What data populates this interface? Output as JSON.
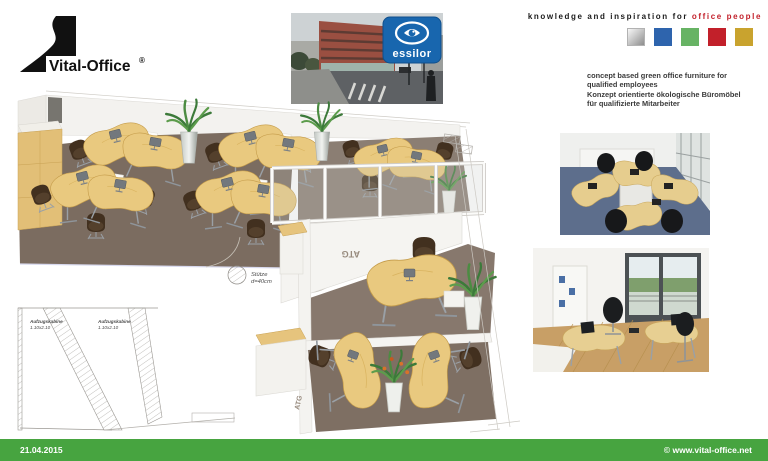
{
  "brand": {
    "name": "Vital-Office",
    "reg": "®"
  },
  "tagline": {
    "text_black": "knowledge and inspiration for",
    "text_red": "office people",
    "square_colors": [
      "silver",
      "#2e64ad",
      "#67b364",
      "#c2202a",
      "#c9a32e"
    ]
  },
  "description": {
    "line1": "concept based green office furniture for",
    "line2": "qualified employees",
    "line3": "Konzept orientierte ökologische Büromöbel",
    "line4": "für qualifizierte Mitarbeiter"
  },
  "essilor": {
    "label": "essilor"
  },
  "plan": {
    "column": {
      "line1": "Stütze",
      "line2": "d=40cm"
    },
    "elevator1": {
      "name": "Aufzugskabine",
      "size": "1.10x2.10"
    },
    "elevator2": {
      "name": "Aufzugskabine",
      "size": "1.10x2.10"
    },
    "room_code": "ATG"
  },
  "footer": {
    "date": "21.04.2015",
    "url": "© www.vital-office.net",
    "bar_color": "#47a440"
  },
  "colors": {
    "accent_red": "#c2202a",
    "carpet": "#7b6c60",
    "desk_wood": "#e9c97f",
    "footer_green": "#47a440"
  }
}
